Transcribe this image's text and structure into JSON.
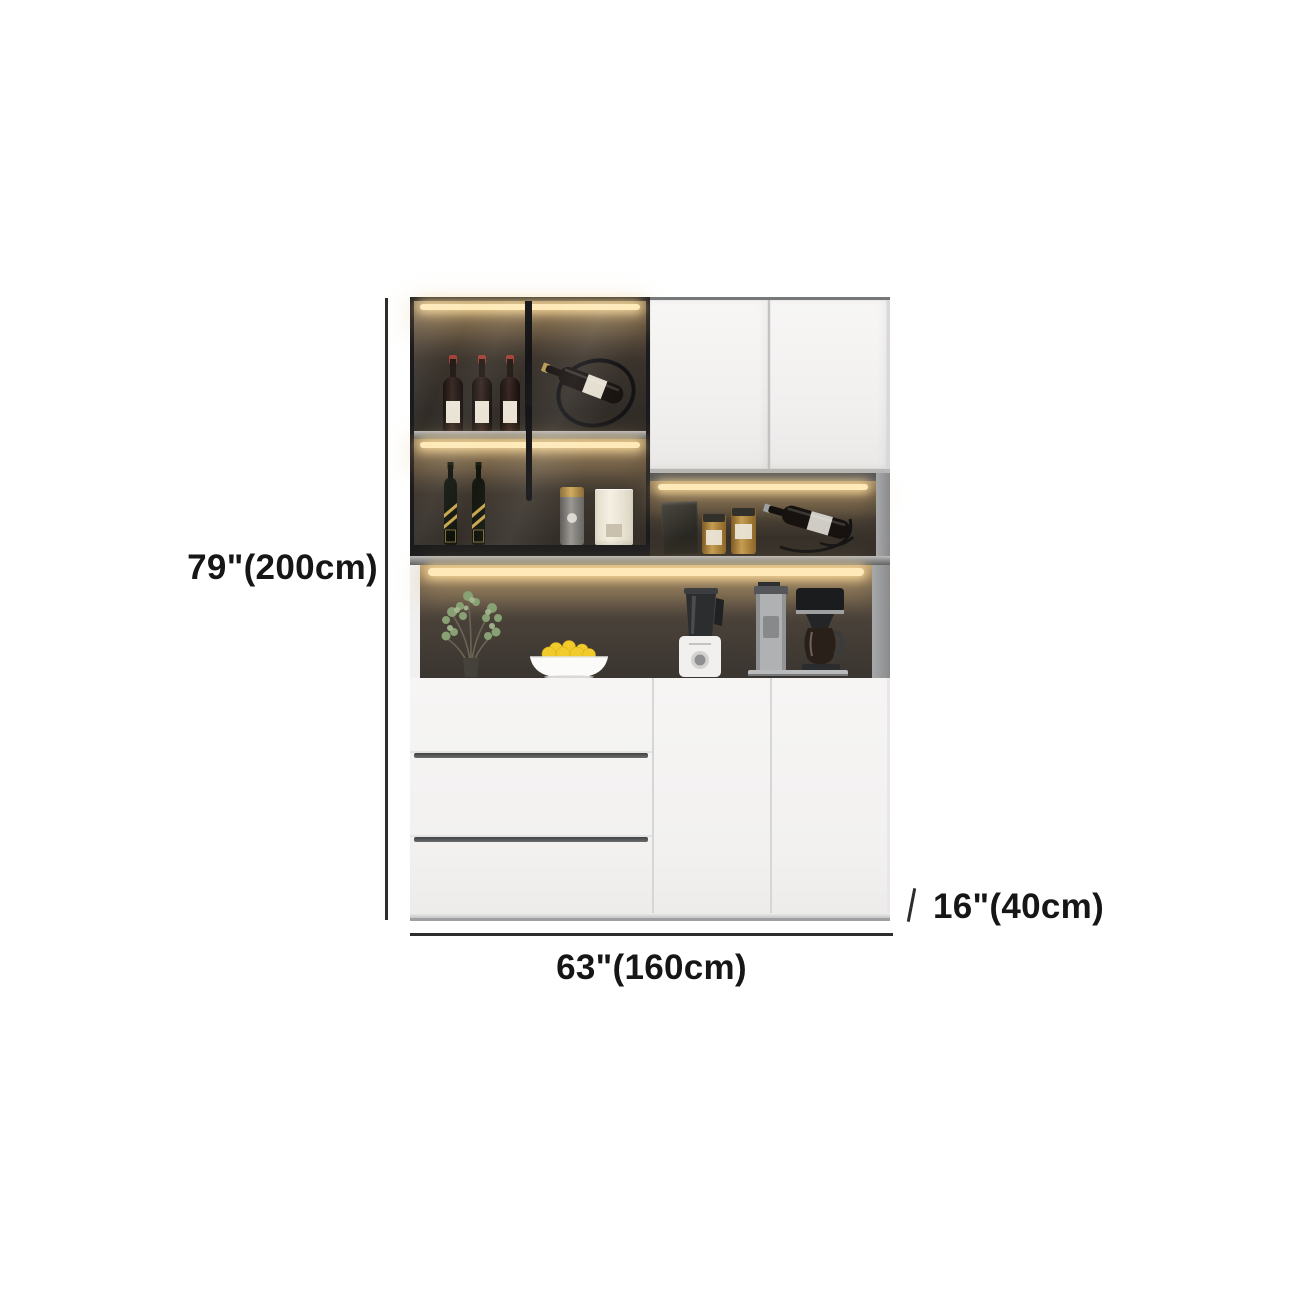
{
  "image_type": "furniture-dimension-diagram",
  "background": "#ffffff",
  "annotations": {
    "height": {
      "label": "79\"(200cm)"
    },
    "width": {
      "label": "63\"(160cm)"
    },
    "depth": {
      "label": "16\"(40cm)"
    },
    "line_color": "#2d2d2d",
    "text_color": "#161616"
  },
  "cabinet": {
    "name": "modern-kitchen-sideboard-hutch",
    "palette": {
      "door_white": "#f3f2f1",
      "frame_black": "#1b1b1d",
      "interior_dark": "#35302a",
      "led_glow": "#ffe9b8",
      "shelf_gray": "#8e9092",
      "handle_gray": "#474749"
    },
    "sections": {
      "upper_left": "glass-door display cabinet with LED lighting",
      "upper_right": "two white cabinet doors",
      "middle": "open LED-lit shelf and countertop niche",
      "lower_left": "three drawers",
      "lower_right": "two cabinet doors"
    },
    "decor": [
      "three wine bottles",
      "wine bottle on rack",
      "two whisky bottles",
      "canister",
      "storage tin",
      "dark gift box",
      "two spice jars",
      "reclined wine bottle on stand",
      "potted plant",
      "bowl of lemons",
      "blender",
      "coffee maker"
    ]
  }
}
